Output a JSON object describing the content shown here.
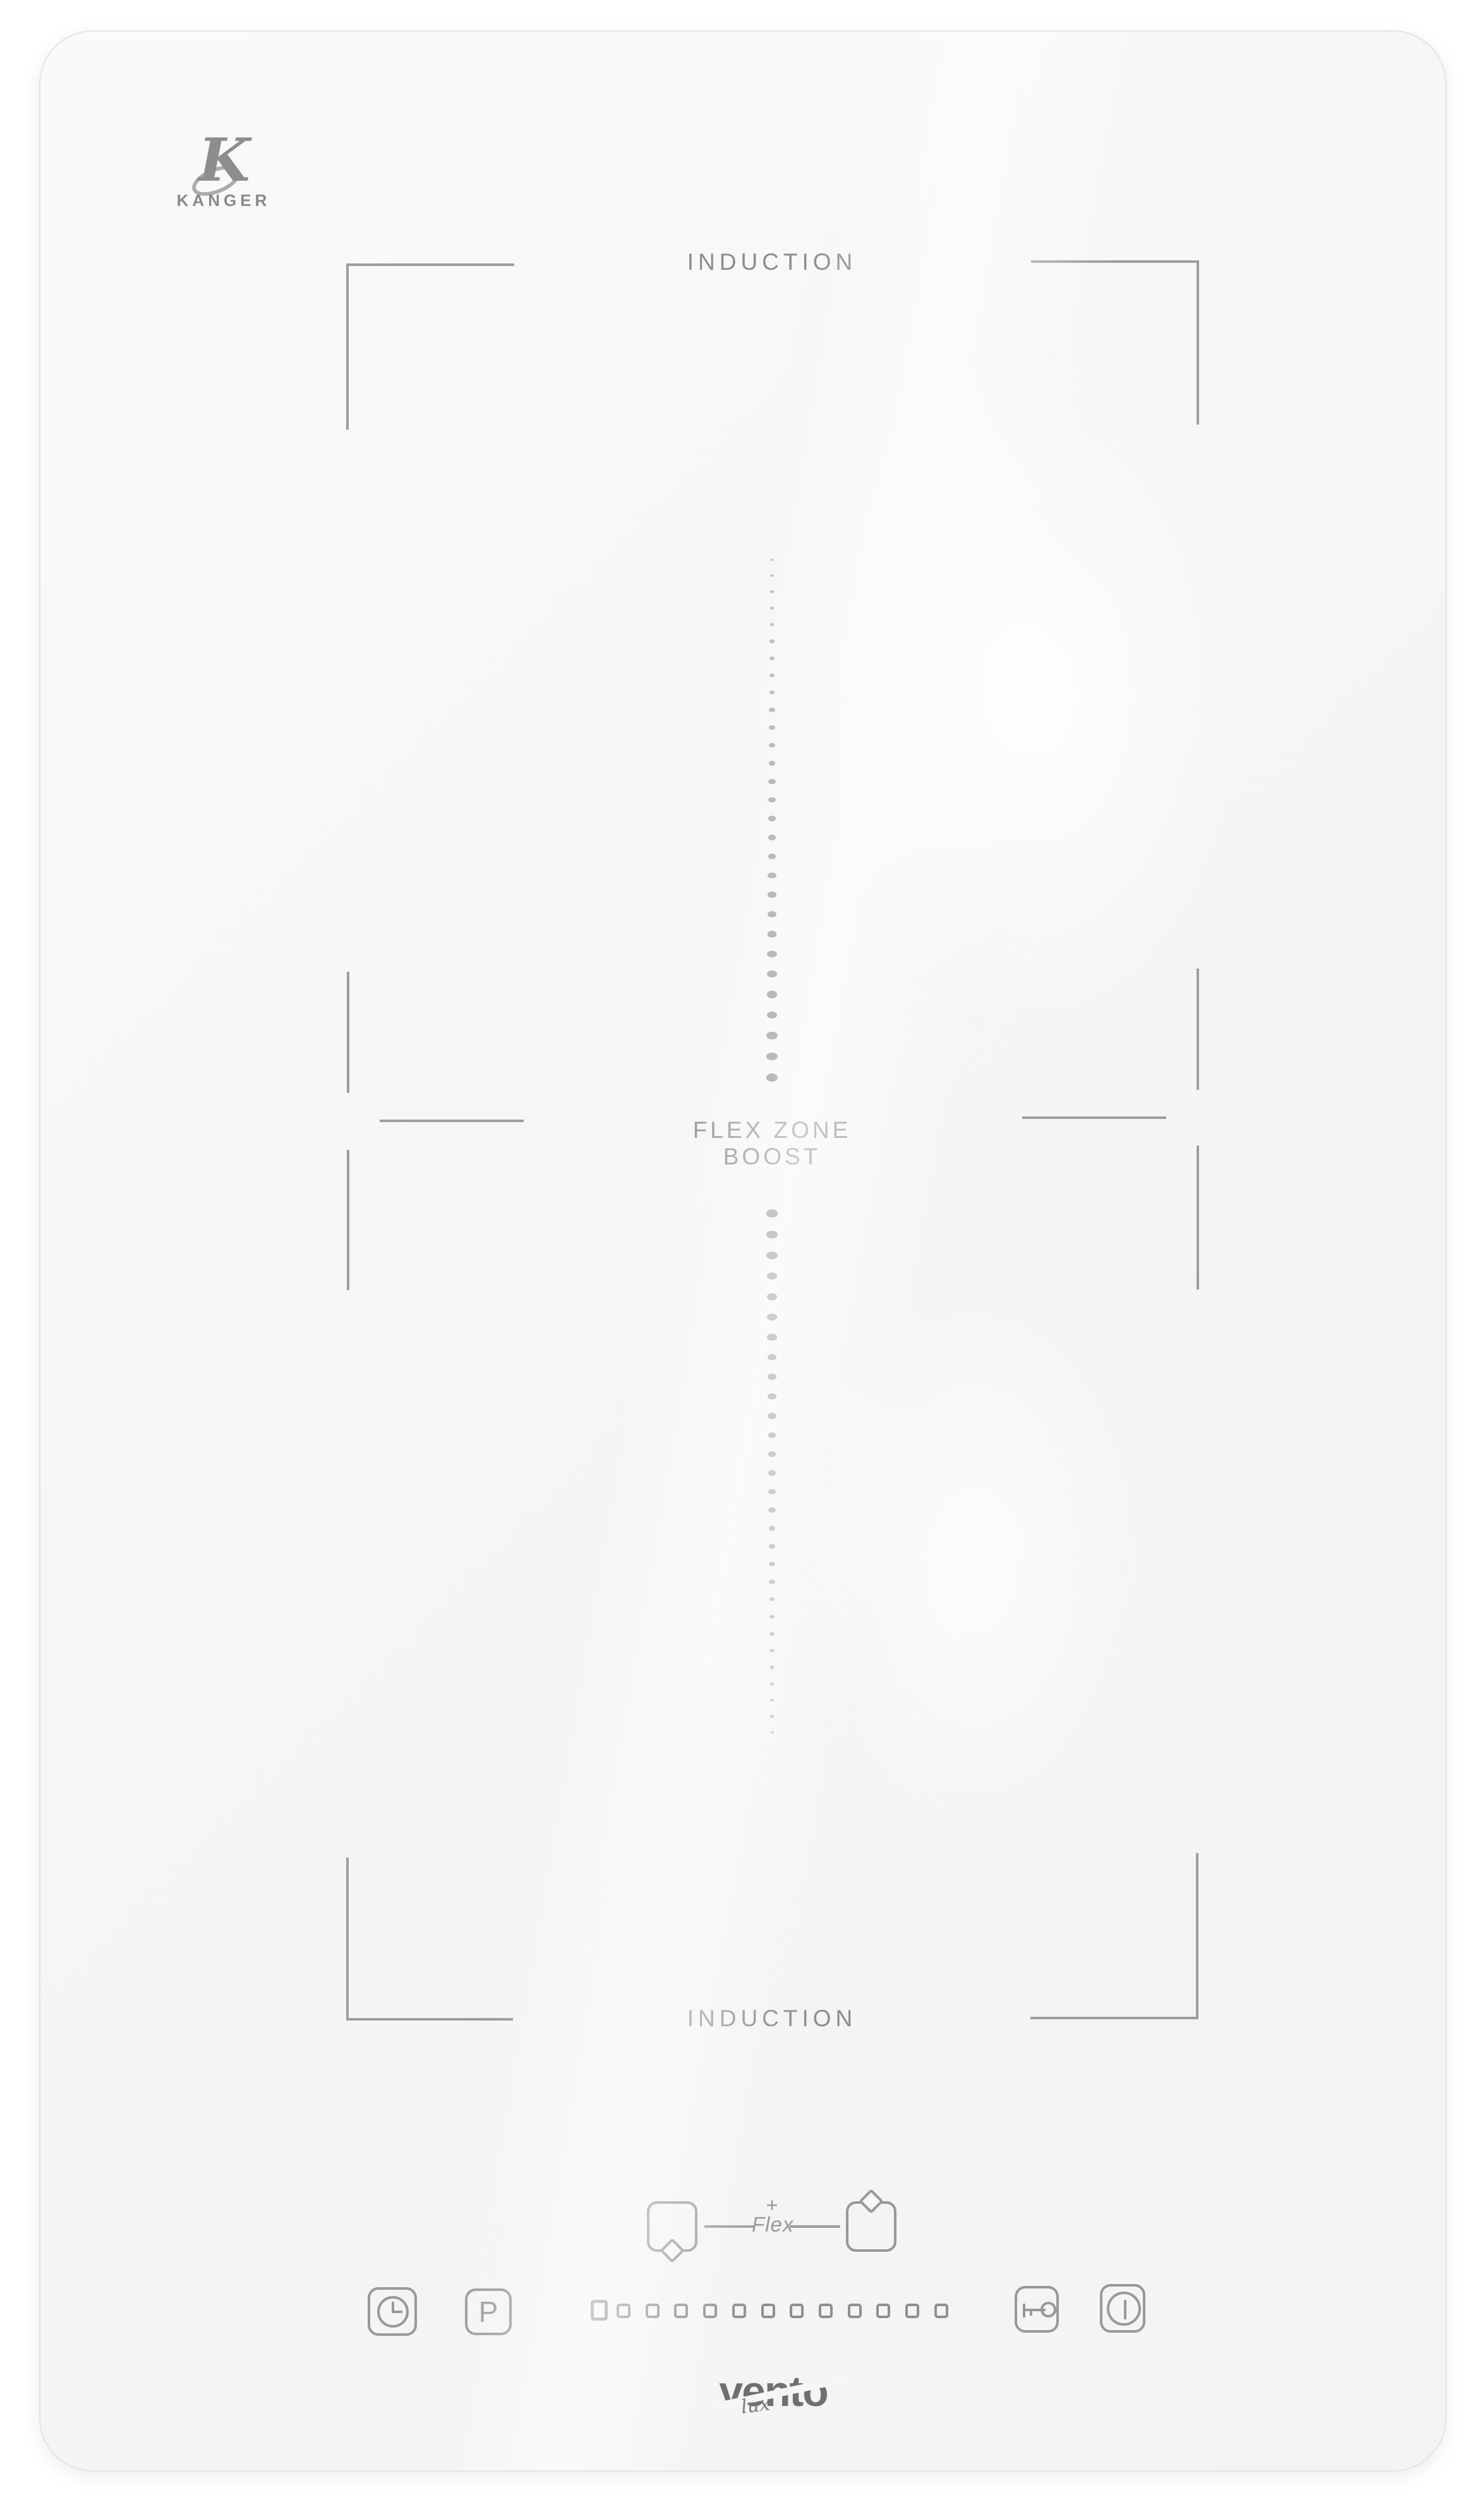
{
  "colors": {
    "line": "#9d9d9d",
    "text": "#8c8c8c",
    "icon": "#989898",
    "logo_dark": "#6f6f6f",
    "panel": "#f6f6f7"
  },
  "brand_top": {
    "mark": "K",
    "name": "KANGER"
  },
  "labels": {
    "zone_top": "INDUCTION",
    "flex_line1": "FLEX ZONE",
    "flex_line2": "BOOST",
    "zone_bottom": "INDUCTION"
  },
  "flex_control": {
    "plus": "+",
    "label": "Flex"
  },
  "controls": {
    "timer": {
      "icon": "clock-icon"
    },
    "boost": {
      "label": "P"
    },
    "level_strip": {
      "large_squares": 1,
      "small_squares": 12
    },
    "lock": {
      "icon": "key-icon"
    },
    "power": {
      "icon": "power-icon"
    }
  },
  "dot_guides": {
    "columns": 2,
    "dots_per_column": 29
  },
  "brand_bottom": {
    "name": "vento",
    "sub": "lux"
  }
}
